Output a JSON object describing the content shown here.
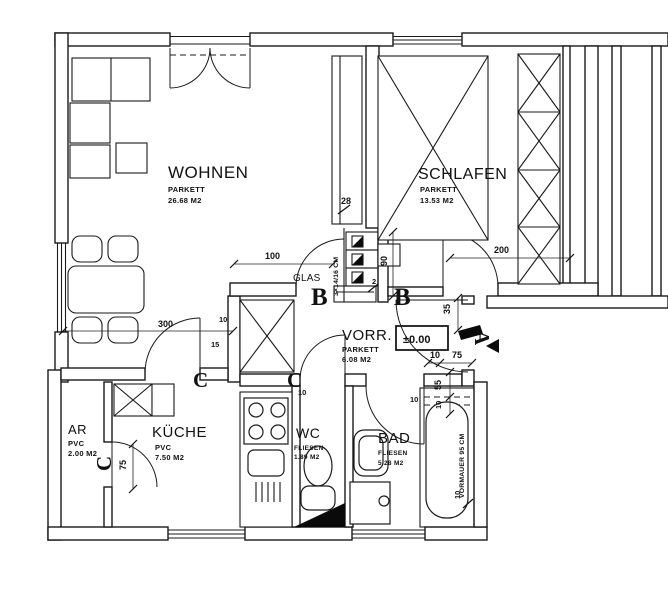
{
  "rooms": {
    "wohnen": {
      "name": "WOHNEN",
      "floor": "PARKETT",
      "area": "26.68 M2"
    },
    "schlafen": {
      "name": "SCHLAFEN",
      "floor": "PARKETT",
      "area": "13.53 M2"
    },
    "vorr": {
      "name": "VORR.",
      "floor": "PARKETT",
      "area": "6.08 M2",
      "level": "±0.00"
    },
    "ar": {
      "name": "AR",
      "floor": "PVC",
      "area": "2.00 M2"
    },
    "kueche": {
      "name": "KÜCHE",
      "floor": "PVC",
      "area": "7.50 M2"
    },
    "wc": {
      "name": "WC",
      "floor": "FLIESEN",
      "area": "1.89 M2"
    },
    "bad": {
      "name": "BAD",
      "floor": "FLIESEN",
      "area": "5.28 M2"
    }
  },
  "annotations": {
    "glas": "GLAS",
    "stair": "3×14/16 CM",
    "vormauer": "VORMAUER 95 CM"
  },
  "markers": {
    "a": "A",
    "b": "B",
    "c": "C"
  },
  "dims": {
    "d2": "2",
    "d10": "10",
    "d15": "15",
    "d28": "28",
    "d35": "35",
    "d55": "55",
    "d75": "75",
    "d90": "90",
    "d100": "100",
    "d200": "200",
    "d300": "300"
  }
}
